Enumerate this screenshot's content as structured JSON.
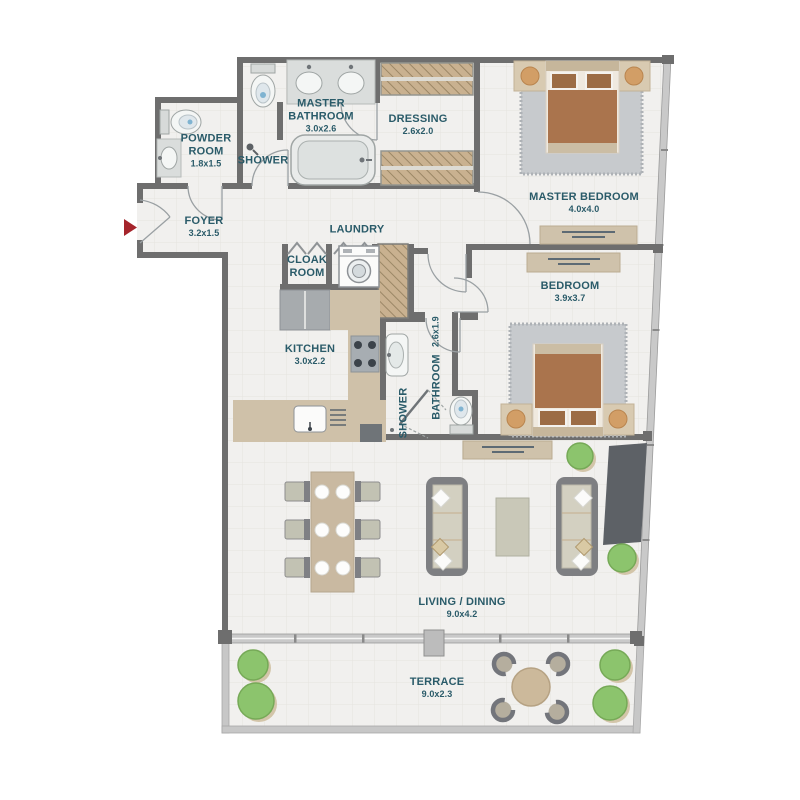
{
  "title": "Apartment floor plan",
  "colors": {
    "wall": "#6e6e6e",
    "floor": "#f1f0ee",
    "grid": "#e5e3df",
    "window_wall": "#c9c9c9",
    "label_text": "#2a5b69",
    "counter_wood": "#cfc1a9",
    "furniture_wood": "#c9b9a1",
    "bed_brown": "#aa744d",
    "rug_gray": "#c7cacd",
    "plant_green": "#8cc46d",
    "entry_arrow_red": "#a5242b"
  },
  "rooms": [
    {
      "id": "powder-room",
      "name": "POWDER ROOM",
      "dims": "1.8x1.5"
    },
    {
      "id": "shower-master",
      "name": "SHOWER",
      "dims": ""
    },
    {
      "id": "master-bathroom",
      "name": "MASTER BATHROOM",
      "dims": "3.0x2.6"
    },
    {
      "id": "dressing",
      "name": "DRESSING",
      "dims": "2.6x2.0"
    },
    {
      "id": "foyer",
      "name": "FOYER",
      "dims": "3.2x1.5"
    },
    {
      "id": "laundry",
      "name": "LAUNDRY",
      "dims": ""
    },
    {
      "id": "cloak-room",
      "name": "CLOAK ROOM",
      "dims": ""
    },
    {
      "id": "master-bedroom",
      "name": "MASTER BEDROOM",
      "dims": "4.0x4.0"
    },
    {
      "id": "bedroom",
      "name": "BEDROOM",
      "dims": "3.9x3.7"
    },
    {
      "id": "kitchen",
      "name": "KITCHEN",
      "dims": "3.0x2.2"
    },
    {
      "id": "bathroom",
      "name": "BATHROOM",
      "dims": "2.6x1.9"
    },
    {
      "id": "shower-bathroom",
      "name": "SHOWER",
      "dims": ""
    },
    {
      "id": "living-dining",
      "name": "LIVING / DINING",
      "dims": "9.0x4.2"
    },
    {
      "id": "terrace",
      "name": "TERRACE",
      "dims": "9.0x2.3"
    }
  ],
  "fixtures": [
    "entry-arrow",
    "toilet",
    "sink",
    "double-vanity",
    "bathtub",
    "shower-head",
    "washing-machine",
    "bifold-door",
    "wardrobe",
    "duct-shaft",
    "fridge",
    "kitchen-counter",
    "stove",
    "kitchen-sink",
    "dishwasher",
    "bed",
    "nightstand",
    "rug",
    "dresser",
    "sideboard",
    "sofa",
    "coffee-table",
    "tv-unit",
    "dining-table",
    "dining-chair",
    "plate",
    "plant",
    "terrace-table",
    "terrace-chair"
  ]
}
